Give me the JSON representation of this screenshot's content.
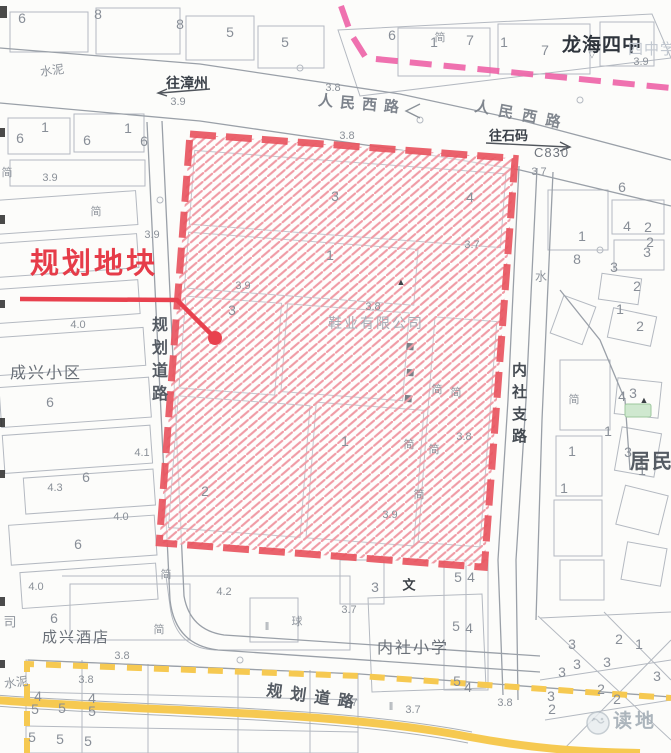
{
  "colors": {
    "parcel_boundary_red": "#e85560",
    "hatch_pink": "#f09ba5",
    "callout_red": "#e63c49",
    "magenta_dashed_line": "#ed62a6",
    "yellow_road": "#f6c951",
    "base_line_gray": "#b4b9c1",
    "road_gray": "#9aa0a8"
  },
  "map": {
    "plot_callout": {
      "label": "规划地块"
    },
    "roads": {
      "renmin_west_1": "人民西路",
      "renmin_west_2": "人民西路",
      "planned_road_left": "规划道路",
      "planned_road_bottom": "规划道路",
      "neishe_branch": "内社支路",
      "code": "C830"
    },
    "directions": {
      "to_zhangzhou": "往漳州",
      "to_shima": "往石码"
    },
    "places": {
      "longhai_no4": "龙海四中",
      "longhai_no4_faint": "四中学",
      "chengxing_estate": "成兴小区",
      "chengxing_hotel": "成兴酒店",
      "neishe_primary": "内社小学",
      "residents": "居民",
      "shoe_company": "鞋业有限公司"
    },
    "watermark": "读地",
    "elevations": [
      {
        "t": "3.9",
        "x": 178,
        "y": 102
      },
      {
        "t": "3.8",
        "x": 333,
        "y": 88
      },
      {
        "t": "3.8",
        "x": 347,
        "y": 136
      },
      {
        "t": "3.9",
        "x": 641,
        "y": 62
      },
      {
        "t": "3.7",
        "x": 539,
        "y": 172
      },
      {
        "t": "3.9",
        "x": 50,
        "y": 178
      },
      {
        "t": "3.9",
        "x": 152,
        "y": 235
      },
      {
        "t": "3.9",
        "x": 243,
        "y": 286
      },
      {
        "t": "3.8",
        "x": 373,
        "y": 307
      },
      {
        "t": "3.7",
        "x": 472,
        "y": 245
      },
      {
        "t": "3.8",
        "x": 464,
        "y": 437
      },
      {
        "t": "3.9",
        "x": 390,
        "y": 515
      },
      {
        "t": "4.0",
        "x": 78,
        "y": 325
      },
      {
        "t": "4.3",
        "x": 55,
        "y": 488
      },
      {
        "t": "4.1",
        "x": 142,
        "y": 453
      },
      {
        "t": "4.0",
        "x": 121,
        "y": 517
      },
      {
        "t": "4.0",
        "x": 36,
        "y": 587
      },
      {
        "t": "4.2",
        "x": 224,
        "y": 592
      },
      {
        "t": "3.8",
        "x": 122,
        "y": 656
      },
      {
        "t": "3.8",
        "x": 86,
        "y": 680
      },
      {
        "t": "3.7",
        "x": 349,
        "y": 610
      },
      {
        "t": "3.7",
        "x": 350,
        "y": 703
      },
      {
        "t": "3.7",
        "x": 413,
        "y": 710
      },
      {
        "t": "3.8",
        "x": 505,
        "y": 703
      }
    ],
    "building_numbers": [
      {
        "t": "6",
        "x": 22,
        "y": 18
      },
      {
        "t": "8",
        "x": 98,
        "y": 14
      },
      {
        "t": "8",
        "x": 180,
        "y": 24
      },
      {
        "t": "5",
        "x": 230,
        "y": 32
      },
      {
        "t": "5",
        "x": 285,
        "y": 42
      },
      {
        "t": "1",
        "x": 45,
        "y": 127
      },
      {
        "t": "6",
        "x": 20,
        "y": 138
      },
      {
        "t": "6",
        "x": 87,
        "y": 140
      },
      {
        "t": "1",
        "x": 128,
        "y": 128
      },
      {
        "t": "6",
        "x": 144,
        "y": 141
      },
      {
        "t": "6",
        "x": 392,
        "y": 35
      },
      {
        "t": "1",
        "x": 434,
        "y": 42
      },
      {
        "t": "7",
        "x": 470,
        "y": 40
      },
      {
        "t": "1",
        "x": 504,
        "y": 42
      },
      {
        "t": "7",
        "x": 545,
        "y": 50
      },
      {
        "t": "6",
        "x": 50,
        "y": 402
      },
      {
        "t": "6",
        "x": 86,
        "y": 477
      },
      {
        "t": "6",
        "x": 78,
        "y": 544
      },
      {
        "t": "6",
        "x": 54,
        "y": 618
      },
      {
        "t": "3",
        "x": 232,
        "y": 310
      },
      {
        "t": "3",
        "x": 335,
        "y": 196
      },
      {
        "t": "1",
        "x": 330,
        "y": 255
      },
      {
        "t": "1",
        "x": 345,
        "y": 441
      },
      {
        "t": "2",
        "x": 205,
        "y": 491
      },
      {
        "t": "4",
        "x": 470,
        "y": 197
      },
      {
        "t": "6",
        "x": 622,
        "y": 187
      },
      {
        "t": "1",
        "x": 582,
        "y": 236
      },
      {
        "t": "4",
        "x": 627,
        "y": 226
      },
      {
        "t": "2",
        "x": 648,
        "y": 227
      },
      {
        "t": "2",
        "x": 650,
        "y": 242
      },
      {
        "t": "3",
        "x": 647,
        "y": 252
      },
      {
        "t": "8",
        "x": 577,
        "y": 259
      },
      {
        "t": "3",
        "x": 614,
        "y": 267
      },
      {
        "t": "2",
        "x": 637,
        "y": 286
      },
      {
        "t": "1",
        "x": 620,
        "y": 309
      },
      {
        "t": "2",
        "x": 640,
        "y": 326
      },
      {
        "t": "4",
        "x": 622,
        "y": 396
      },
      {
        "t": "3",
        "x": 633,
        "y": 393
      },
      {
        "t": "3",
        "x": 628,
        "y": 452
      },
      {
        "t": "1",
        "x": 608,
        "y": 431
      },
      {
        "t": "1",
        "x": 572,
        "y": 451
      },
      {
        "t": "1",
        "x": 564,
        "y": 488
      },
      {
        "t": "1",
        "x": 642,
        "y": 470
      },
      {
        "t": "4",
        "x": 38,
        "y": 696
      },
      {
        "t": "5",
        "x": 35,
        "y": 709
      },
      {
        "t": "5",
        "x": 62,
        "y": 708
      },
      {
        "t": "4",
        "x": 92,
        "y": 698
      },
      {
        "t": "5",
        "x": 92,
        "y": 711
      },
      {
        "t": "5",
        "x": 32,
        "y": 737
      },
      {
        "t": "5",
        "x": 60,
        "y": 739
      },
      {
        "t": "5",
        "x": 88,
        "y": 741
      },
      {
        "t": "3",
        "x": 375,
        "y": 587
      },
      {
        "t": "5",
        "x": 458,
        "y": 577
      },
      {
        "t": "4",
        "x": 471,
        "y": 577
      },
      {
        "t": "5",
        "x": 456,
        "y": 626
      },
      {
        "t": "4",
        "x": 469,
        "y": 628
      },
      {
        "t": "5",
        "x": 457,
        "y": 681
      },
      {
        "t": "4",
        "x": 468,
        "y": 687
      },
      {
        "t": "3",
        "x": 572,
        "y": 644
      },
      {
        "t": "2",
        "x": 619,
        "y": 639
      },
      {
        "t": "1",
        "x": 639,
        "y": 644
      },
      {
        "t": "3",
        "x": 577,
        "y": 664
      },
      {
        "t": "3",
        "x": 607,
        "y": 662
      },
      {
        "t": "3",
        "x": 562,
        "y": 672
      },
      {
        "t": "2",
        "x": 601,
        "y": 689
      },
      {
        "t": "2",
        "x": 617,
        "y": 699
      },
      {
        "t": "3",
        "x": 551,
        "y": 696
      },
      {
        "t": "2",
        "x": 552,
        "y": 709
      },
      {
        "t": "3",
        "x": 657,
        "y": 676
      }
    ],
    "glyphs": [
      {
        "t": "水泥",
        "x": 52,
        "y": 70,
        "s": 12,
        "r": -8
      },
      {
        "t": "水泥",
        "x": 16,
        "y": 682,
        "s": 12,
        "r": -8
      },
      {
        "t": "司",
        "x": 10,
        "y": 621,
        "s": 13
      },
      {
        "t": "水",
        "x": 541,
        "y": 276,
        "s": 12
      },
      {
        "t": "简",
        "x": 7,
        "y": 172
      },
      {
        "t": "简",
        "x": 96,
        "y": 211
      },
      {
        "t": "简",
        "x": 440,
        "y": 37
      },
      {
        "t": "简",
        "x": 437,
        "y": 389
      },
      {
        "t": "简",
        "x": 456,
        "y": 392
      },
      {
        "t": "简",
        "x": 409,
        "y": 444
      },
      {
        "t": "简",
        "x": 434,
        "y": 449
      },
      {
        "t": "简",
        "x": 419,
        "y": 494
      },
      {
        "t": "简",
        "x": 166,
        "y": 574
      },
      {
        "t": "简",
        "x": 159,
        "y": 629
      },
      {
        "t": "简",
        "x": 574,
        "y": 399
      },
      {
        "t": "球",
        "x": 297,
        "y": 621,
        "s": 11
      },
      {
        "t": "文",
        "x": 409,
        "y": 584,
        "s": 13,
        "c": "dark"
      },
      {
        "t": "▲",
        "x": 401,
        "y": 282,
        "s": 9,
        "c": "dark"
      },
      {
        "t": "▲",
        "x": 644,
        "y": 400,
        "s": 9,
        "c": "dark"
      },
      {
        "t": "▽",
        "x": 592,
        "y": 55,
        "s": 9
      },
      {
        "t": "‖",
        "x": 267,
        "y": 627,
        "s": 11
      },
      {
        "t": "‖",
        "x": 391,
        "y": 707,
        "s": 11
      }
    ]
  }
}
